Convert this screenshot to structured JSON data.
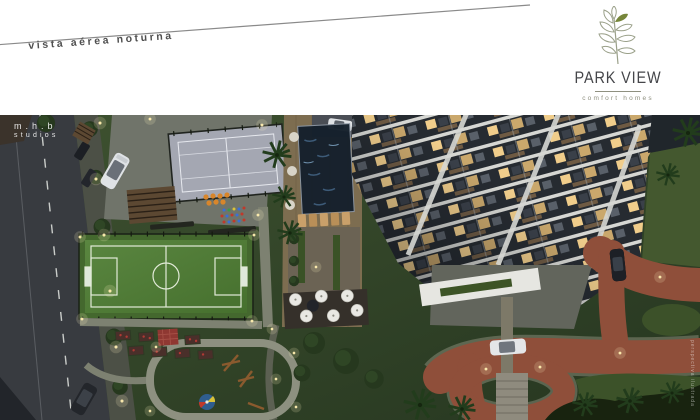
{
  "header": {
    "caption": "vista aérea noturna"
  },
  "logo": {
    "title": "PARK VIEW",
    "tagline": "comfort homes",
    "brand_green": "#76863a",
    "line_art_color": "#9aa089",
    "title_color": "#45464a",
    "tagline_color": "#8f9080"
  },
  "watermarks": {
    "studio_top": "m.h.b",
    "studio_bottom": "studios",
    "side_vertical": "perspectiva ilustrada"
  },
  "scene": {
    "alt": "aerial night view of Park View condominium: street, sports court, soccer field, playground, pool deck, apartment tower and driveway",
    "palette": {
      "grass": "#35482a",
      "road": "#383b40",
      "court": "#a4a7b2",
      "soccer_field": "#4f7a38",
      "pool": "#15202c",
      "wood_deck": "#7d6d50",
      "building_dark": "#262b31",
      "building_slab": "#d6d7d3",
      "lit_window": "#f0cd8b",
      "driveway_brick": "#8f4f3a"
    }
  }
}
